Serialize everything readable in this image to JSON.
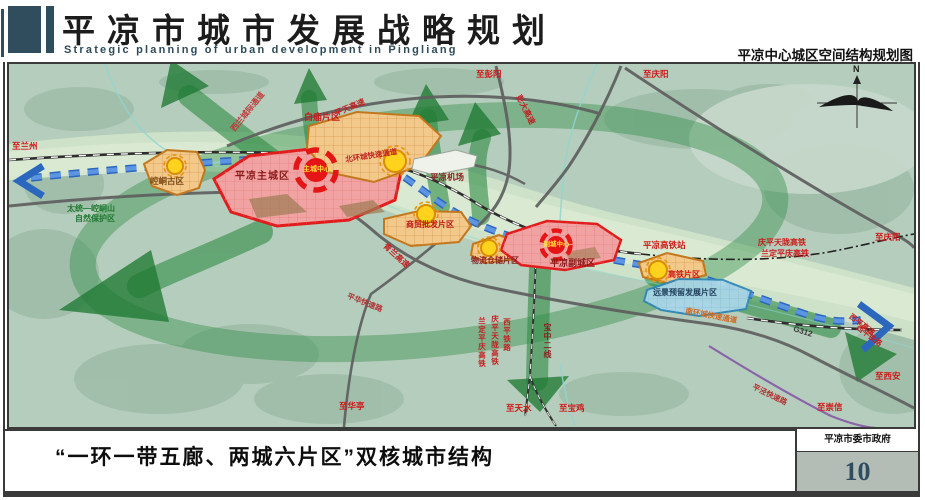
{
  "header": {
    "title": "平凉市城市发展战略规划",
    "subtitle": "Strategic planning of urban development in Pingliang",
    "map_title": "平凉中心城区空间结构规划图"
  },
  "footer": {
    "caption": "“一环一带五廊、两城六片区”双核城市结构",
    "org": "平凉市委市政府",
    "page_number": "10"
  },
  "map": {
    "labels": {
      "compass_n": "N",
      "to_lanzhou": "至兰州",
      "nature_reserve_1": "太统—崆峒山",
      "nature_reserve_2": "自然保护区",
      "intercity_corridor": "西兰城际通道",
      "pingtian_expwy": "平天高速",
      "north_ring": "北环城快速通道",
      "baimiao_zone": "白庙片区",
      "to_pengyang": "至彭阳",
      "pengda_expwy": "彭大高速",
      "to_qingyang_top": "至庆阳",
      "airport": "平凉机场",
      "kongtong_zone": "崆峒古区",
      "main_city": "平凉主城区",
      "main_center": "主城中心",
      "trade_zone": "商贸批发片区",
      "logistics_zone": "物流仓储片区",
      "sub_city": "平凉副城区",
      "sub_center": "副城中心",
      "hsr_zone": "高铁片区",
      "reserved_zone": "远景预留发展片区",
      "hsr_station": "平凉高铁站",
      "qptl_hsr": "庆平天陇高铁",
      "ldpq_hsr": "兰定平庆高铁",
      "to_qingyang_right": "至庆阳",
      "south_ring": "南环城快速通道",
      "g312": "G312",
      "xiping_expwy": "西平高速",
      "xiping_rail": "西平铁路",
      "to_xian": "至西安",
      "pingjing_expwy": "平泾快速路",
      "to_chongxin": "至崇信",
      "to_tianshui": "至天水",
      "to_baoji": "至宝鸡",
      "to_huating": "至华亭",
      "baozhong_rail": "宝中二线",
      "xiping_rail_v": "西平铁路",
      "qptl_hsr_v": "庆平天陇高铁",
      "ldpq_hsr_v": "兰定平庆高铁",
      "pinghua_expwy": "平华快速路",
      "qinglan_expwy": "青兰高速"
    },
    "colors": {
      "header_dark": "#2f4d5c",
      "corridor_green": "#2f8c44",
      "zone_red": "#e21c1c",
      "zone_orange": "#c2771c",
      "axis_blue": "#2c67be",
      "label_red": "#d01818"
    }
  }
}
